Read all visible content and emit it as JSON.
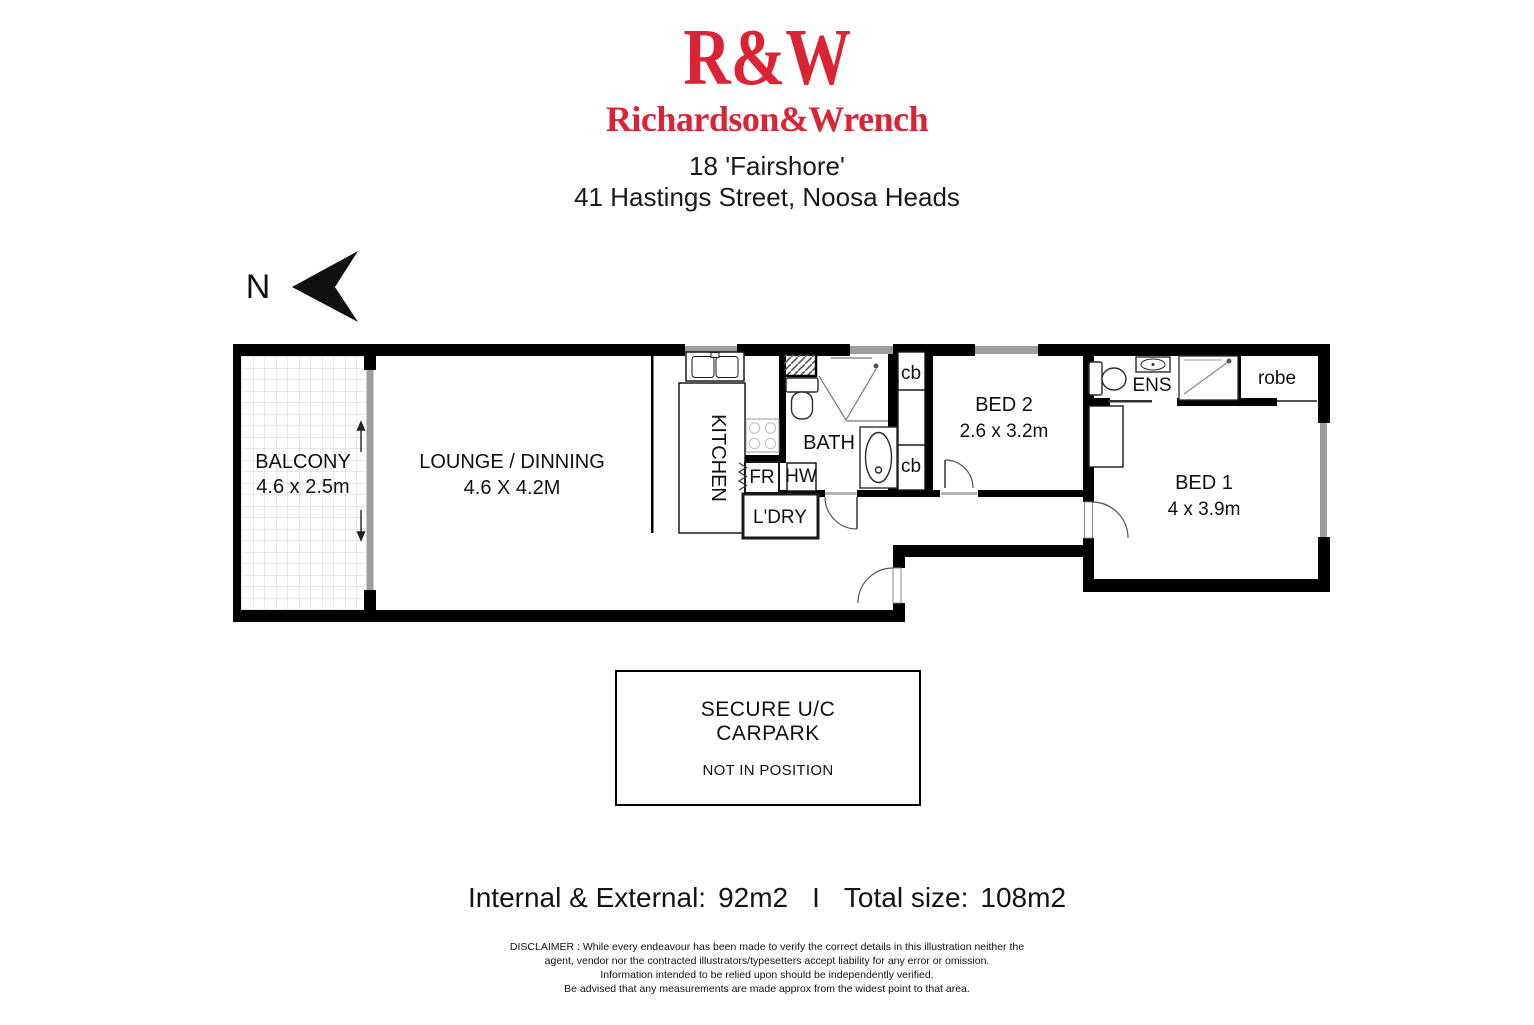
{
  "header": {
    "logo_acronym": "R&W",
    "logo_name": "Richardson&Wrench",
    "address_line1": "18 'Fairshore'",
    "address_line2": "41 Hastings Street, Noosa Heads",
    "brand_color": "#da2334"
  },
  "compass": {
    "north_label": "N"
  },
  "floorplan": {
    "balcony": {
      "name": "BALCONY",
      "dims": "4.6 x 2.5m"
    },
    "lounge": {
      "name": "LOUNGE / DINNING",
      "dims": "4.6 X 4.2M"
    },
    "kitchen": {
      "name": "KITCHEN"
    },
    "bath": {
      "name": "BATH"
    },
    "laundry": {
      "name": "L'DRY"
    },
    "fridge": {
      "name": "FR"
    },
    "hot_water": {
      "name": "HW"
    },
    "cupboard_top": {
      "name": "cb"
    },
    "cupboard_bottom": {
      "name": "cb"
    },
    "bed2": {
      "name": "BED 2",
      "dims": "2.6 x 3.2m"
    },
    "ensuite": {
      "name": "ENS"
    },
    "robe": {
      "name": "robe"
    },
    "bed1": {
      "name": "BED 1",
      "dims": "4 x 3.9m"
    }
  },
  "carpark": {
    "line1": "SECURE U/C",
    "line2": "CARPARK",
    "note": "NOT IN POSITION"
  },
  "summary": {
    "label1": "Internal & External:",
    "value1": "92m2",
    "separator": "I",
    "label2": "Total size:",
    "value2": "108m2"
  },
  "disclaimer": {
    "lines": [
      "DISCLAIMER : While every endeavour has been made to verify the correct details in this illustration neither the",
      "agent, vendor nor the contracted illustrators/typesetters accept liability for any error or omission.",
      "Information intended to be relied upon should be independently verified.",
      "Be advised that any measurements are made approx from the widest point to that area."
    ]
  }
}
